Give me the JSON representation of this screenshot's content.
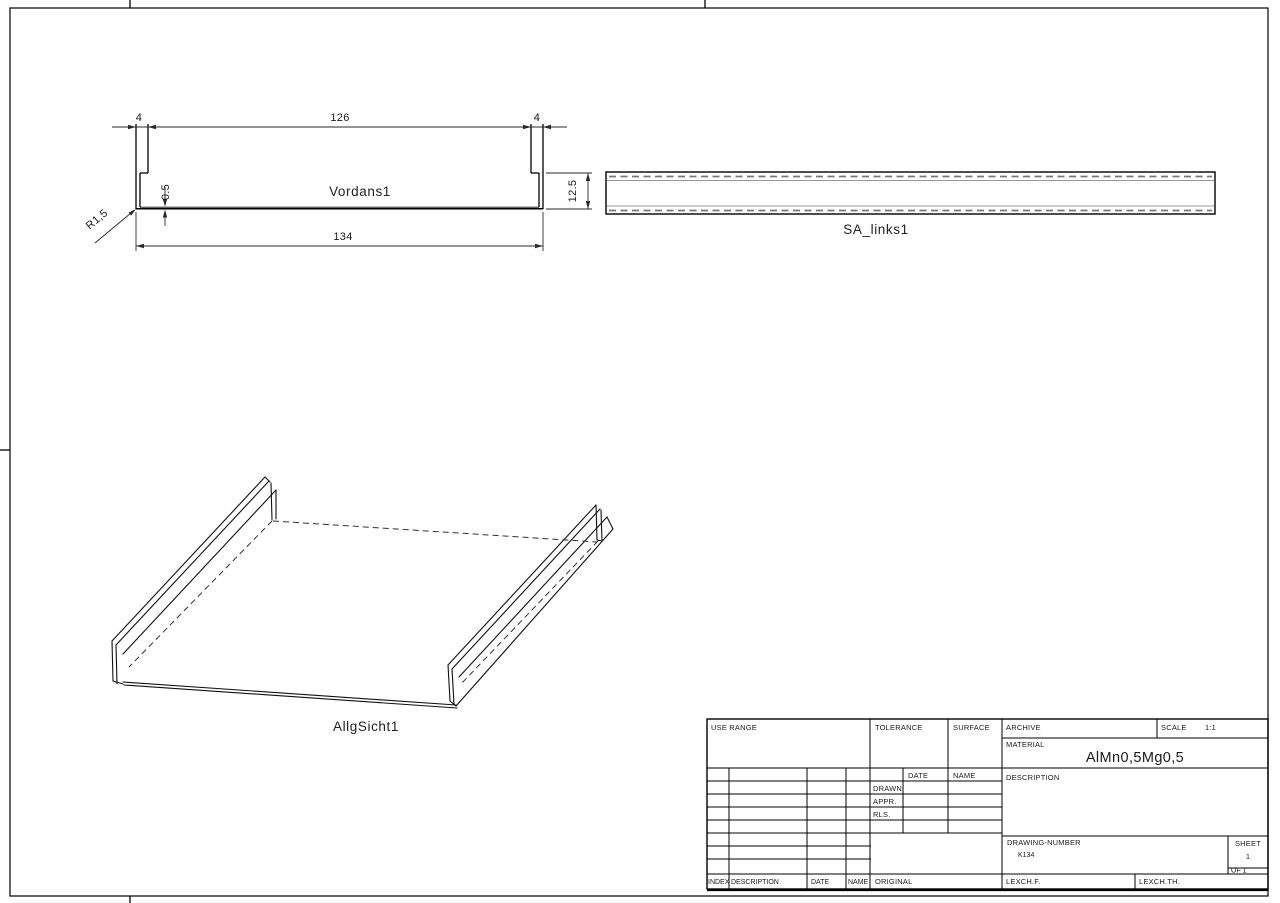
{
  "colors": {
    "ink": "#1a1a1a",
    "paper": "#ffffff"
  },
  "views": {
    "front": {
      "label": "Vordans1",
      "dims": {
        "flange_left": "4",
        "inner_width": "126",
        "flange_right": "4",
        "thickness": "0.5",
        "height": "12.5",
        "overall_width": "134",
        "radius": "R1,5"
      }
    },
    "side": {
      "label": "SA_links1"
    },
    "iso": {
      "label": "AllgSicht1"
    }
  },
  "title_block": {
    "use_range_label": "USE RANGE",
    "tolerance_label": "TOLERANCE",
    "surface_label": "SURFACE",
    "archive_label": "ARCHIVE",
    "scale_label": "SCALE",
    "scale_value": "1:1",
    "material_label": "MATERIAL",
    "material_value": "AlMn0,5Mg0,5",
    "description_label": "DESCRIPTION",
    "signoff": {
      "date_header": "DATE",
      "name_header": "NAME",
      "row_drawn": "DRAWN",
      "row_appr": "APPR.",
      "row_rls": "RLS."
    },
    "drawing_number_label": "DRAWING-NUMBER",
    "drawing_number_value": "K134",
    "sheet_label": "SHEET",
    "sheet_value": "1",
    "of_label": "OF 1",
    "footer": {
      "index": "INDEX",
      "description": "DESCRIPTION",
      "date": "DATE",
      "name": "NAME",
      "original": "ORIGINAL",
      "checker_left": "LEXCH.F.",
      "checker_right": "LEXCH.TH."
    }
  }
}
